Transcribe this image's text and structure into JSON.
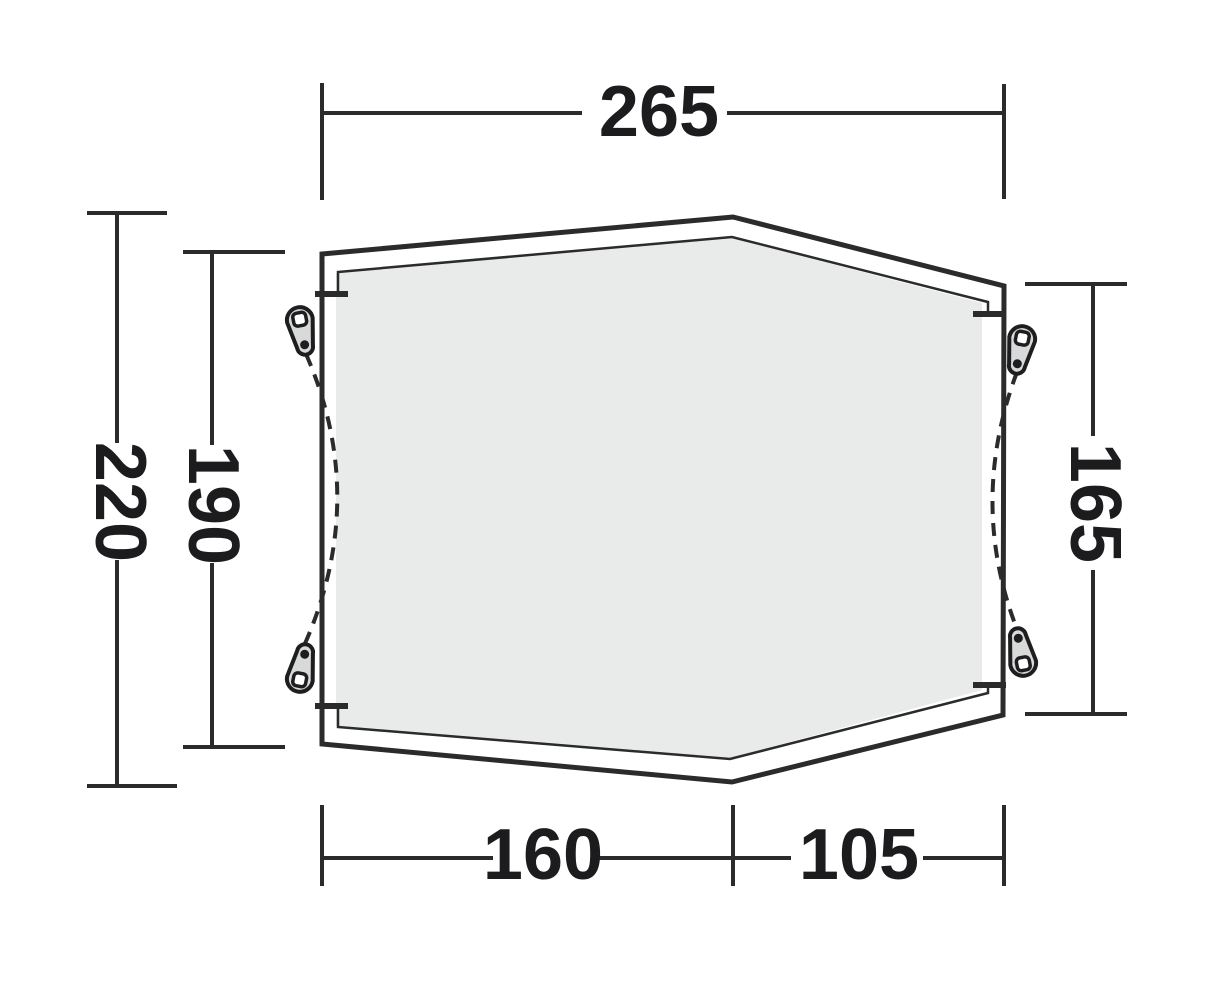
{
  "diagram": {
    "dimensions": {
      "top_width": "265",
      "total_depth": "220",
      "left_side_depth": "190",
      "right_side_depth": "165",
      "bottom_left_width": "160",
      "bottom_right_width": "105"
    },
    "icons": {
      "guyline_attachment": "pull-tab-teardrop"
    },
    "colors": {
      "line": "#2b2b2b",
      "label_text": "#1c1c1e",
      "groundsheet_fill": "#e9ebea",
      "peg_fill": "#d8dad9",
      "background": "#ffffff"
    }
  }
}
